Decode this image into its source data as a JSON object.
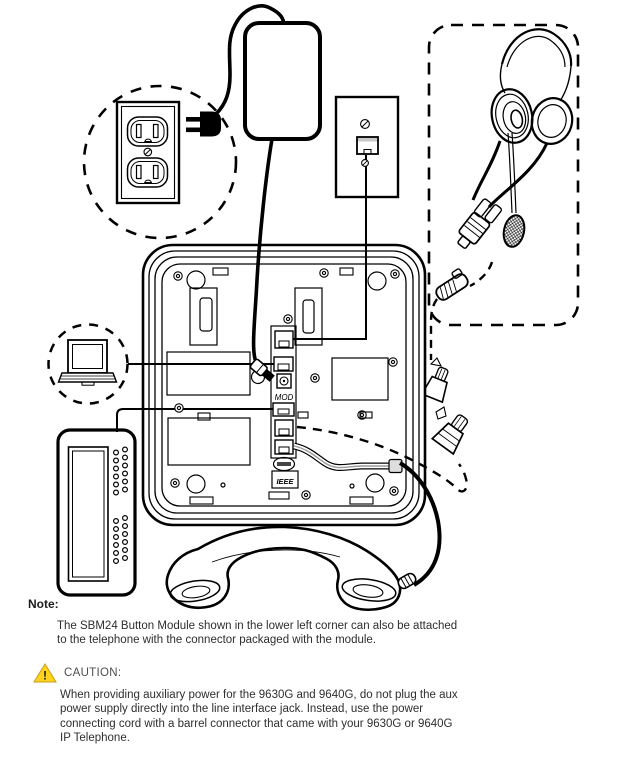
{
  "figure": {
    "labels": {
      "mod_port": "MOD",
      "ieee_port": "IEEE"
    },
    "components": [
      "power-outlet",
      "ac-plug",
      "power-adapter-brick",
      "wall-line-jack",
      "headset",
      "headset-cord-connectors",
      "laptop-pc",
      "ip-telephone-base-rear",
      "sbm24-button-module",
      "handset"
    ]
  },
  "note": {
    "heading": "Note:",
    "lines": [
      "The SBM24 Button Module shown in the lower left corner can also be attached",
      "to the telephone with the connector packaged with the module."
    ]
  },
  "caution": {
    "heading": "CAUTION:",
    "icon_mark": "!",
    "lines": [
      "When providing auxiliary power for the 9630G and 9640G, do not plug the aux",
      "power supply directly into the line interface jack. Instead, use the power",
      "connecting cord with a barrel connector that came with your 9630G or 9640G",
      "IP Telephone."
    ]
  },
  "colors": {
    "ink": "#000000",
    "caution_yellow": "#FFD21E",
    "text": "#2e2e2e",
    "cable_gray": "#9a9a9a"
  }
}
